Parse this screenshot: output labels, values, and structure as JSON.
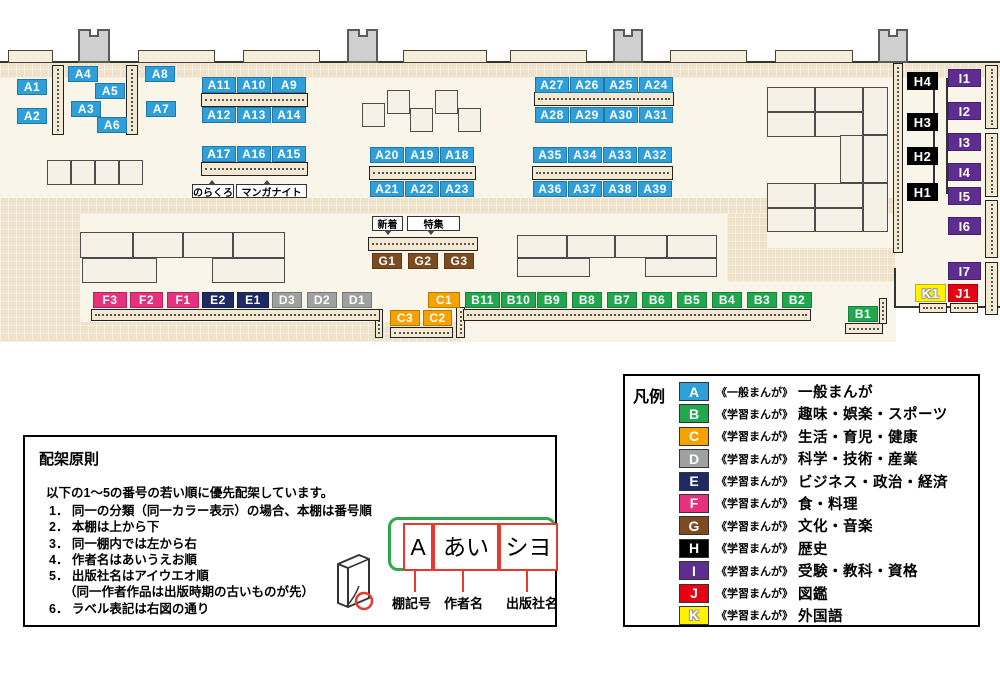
{
  "map": {
    "shelf_labels": [
      {
        "id": "A1",
        "cat": "A",
        "x": 17,
        "y": 79,
        "w": 30
      },
      {
        "id": "A2",
        "cat": "A",
        "x": 17,
        "y": 108,
        "w": 30
      },
      {
        "id": "A4",
        "cat": "A",
        "x": 68,
        "y": 66,
        "w": 30
      },
      {
        "id": "A5",
        "cat": "A",
        "x": 95,
        "y": 83,
        "w": 30
      },
      {
        "id": "A3",
        "cat": "A",
        "x": 71,
        "y": 101,
        "w": 30
      },
      {
        "id": "A6",
        "cat": "A",
        "x": 97,
        "y": 117,
        "w": 30
      },
      {
        "id": "A8",
        "cat": "A",
        "x": 145,
        "y": 66,
        "w": 30
      },
      {
        "id": "A7",
        "cat": "A",
        "x": 146,
        "y": 101,
        "w": 30
      },
      {
        "id": "A11",
        "cat": "A",
        "x": 202,
        "y": 77,
        "w": 34
      },
      {
        "id": "A10",
        "cat": "A",
        "x": 237,
        "y": 77,
        "w": 34
      },
      {
        "id": "A9",
        "cat": "A",
        "x": 272,
        "y": 77,
        "w": 34
      },
      {
        "id": "A12",
        "cat": "A",
        "x": 202,
        "y": 107,
        "w": 34
      },
      {
        "id": "A13",
        "cat": "A",
        "x": 237,
        "y": 107,
        "w": 34
      },
      {
        "id": "A14",
        "cat": "A",
        "x": 272,
        "y": 107,
        "w": 34
      },
      {
        "id": "A17",
        "cat": "A",
        "x": 202,
        "y": 146,
        "w": 34
      },
      {
        "id": "A16",
        "cat": "A",
        "x": 237,
        "y": 146,
        "w": 34
      },
      {
        "id": "A15",
        "cat": "A",
        "x": 272,
        "y": 146,
        "w": 34
      },
      {
        "id": "A20",
        "cat": "A",
        "x": 370,
        "y": 147,
        "w": 34
      },
      {
        "id": "A19",
        "cat": "A",
        "x": 405,
        "y": 147,
        "w": 34
      },
      {
        "id": "A18",
        "cat": "A",
        "x": 440,
        "y": 147,
        "w": 34
      },
      {
        "id": "A21",
        "cat": "A",
        "x": 370,
        "y": 181,
        "w": 34
      },
      {
        "id": "A22",
        "cat": "A",
        "x": 405,
        "y": 181,
        "w": 34
      },
      {
        "id": "A23",
        "cat": "A",
        "x": 440,
        "y": 181,
        "w": 34
      },
      {
        "id": "A27",
        "cat": "A",
        "x": 535,
        "y": 77,
        "w": 34
      },
      {
        "id": "A26",
        "cat": "A",
        "x": 570,
        "y": 77,
        "w": 34
      },
      {
        "id": "A25",
        "cat": "A",
        "x": 604,
        "y": 77,
        "w": 34
      },
      {
        "id": "A24",
        "cat": "A",
        "x": 639,
        "y": 77,
        "w": 34
      },
      {
        "id": "A28",
        "cat": "A",
        "x": 535,
        "y": 107,
        "w": 34
      },
      {
        "id": "A29",
        "cat": "A",
        "x": 570,
        "y": 107,
        "w": 34
      },
      {
        "id": "A30",
        "cat": "A",
        "x": 604,
        "y": 107,
        "w": 34
      },
      {
        "id": "A31",
        "cat": "A",
        "x": 639,
        "y": 107,
        "w": 34
      },
      {
        "id": "A35",
        "cat": "A",
        "x": 533,
        "y": 147,
        "w": 34
      },
      {
        "id": "A34",
        "cat": "A",
        "x": 568,
        "y": 147,
        "w": 34
      },
      {
        "id": "A33",
        "cat": "A",
        "x": 603,
        "y": 147,
        "w": 34
      },
      {
        "id": "A32",
        "cat": "A",
        "x": 638,
        "y": 147,
        "w": 34
      },
      {
        "id": "A36",
        "cat": "A",
        "x": 533,
        "y": 181,
        "w": 34
      },
      {
        "id": "A37",
        "cat": "A",
        "x": 568,
        "y": 181,
        "w": 34
      },
      {
        "id": "A38",
        "cat": "A",
        "x": 603,
        "y": 181,
        "w": 34
      },
      {
        "id": "A39",
        "cat": "A",
        "x": 638,
        "y": 181,
        "w": 34
      },
      {
        "id": "G1",
        "cat": "G",
        "x": 372,
        "y": 253,
        "w": 30
      },
      {
        "id": "G2",
        "cat": "G",
        "x": 408,
        "y": 253,
        "w": 30
      },
      {
        "id": "G3",
        "cat": "G",
        "x": 444,
        "y": 253,
        "w": 30
      },
      {
        "id": "F3",
        "cat": "F",
        "x": 93,
        "y": 292,
        "w": 34
      },
      {
        "id": "F2",
        "cat": "F",
        "x": 130,
        "y": 292,
        "w": 33
      },
      {
        "id": "F1",
        "cat": "F",
        "x": 167,
        "y": 292,
        "w": 32
      },
      {
        "id": "E2",
        "cat": "E",
        "x": 202,
        "y": 292,
        "w": 32
      },
      {
        "id": "E1",
        "cat": "E",
        "x": 237,
        "y": 292,
        "w": 32
      },
      {
        "id": "D3",
        "cat": "D",
        "x": 272,
        "y": 292,
        "w": 30
      },
      {
        "id": "D2",
        "cat": "D",
        "x": 307,
        "y": 292,
        "w": 30
      },
      {
        "id": "D1",
        "cat": "D",
        "x": 342,
        "y": 292,
        "w": 30
      },
      {
        "id": "C1",
        "cat": "C",
        "x": 428,
        "y": 292,
        "w": 32
      },
      {
        "id": "C3",
        "cat": "C",
        "x": 390,
        "y": 310,
        "w": 30
      },
      {
        "id": "C2",
        "cat": "C",
        "x": 423,
        "y": 310,
        "w": 29
      },
      {
        "id": "B11",
        "cat": "B",
        "x": 465,
        "y": 292,
        "w": 35
      },
      {
        "id": "B10",
        "cat": "B",
        "x": 501,
        "y": 292,
        "w": 35
      },
      {
        "id": "B9",
        "cat": "B",
        "x": 537,
        "y": 292,
        "w": 30
      },
      {
        "id": "B8",
        "cat": "B",
        "x": 572,
        "y": 292,
        "w": 30
      },
      {
        "id": "B7",
        "cat": "B",
        "x": 607,
        "y": 292,
        "w": 30
      },
      {
        "id": "B6",
        "cat": "B",
        "x": 642,
        "y": 292,
        "w": 30
      },
      {
        "id": "B5",
        "cat": "B",
        "x": 677,
        "y": 292,
        "w": 30
      },
      {
        "id": "B4",
        "cat": "B",
        "x": 712,
        "y": 292,
        "w": 30
      },
      {
        "id": "B3",
        "cat": "B",
        "x": 747,
        "y": 292,
        "w": 30
      },
      {
        "id": "B2",
        "cat": "B",
        "x": 782,
        "y": 292,
        "w": 30
      },
      {
        "id": "B1",
        "cat": "B",
        "x": 848,
        "y": 306,
        "w": 30
      },
      {
        "id": "H4",
        "cat": "H",
        "x": 907,
        "y": 72,
        "w": 31
      },
      {
        "id": "H3",
        "cat": "H",
        "x": 907,
        "y": 113,
        "w": 31
      },
      {
        "id": "H2",
        "cat": "H",
        "x": 907,
        "y": 147,
        "w": 31
      },
      {
        "id": "H1",
        "cat": "H",
        "x": 907,
        "y": 183,
        "w": 31
      },
      {
        "id": "I1",
        "cat": "I",
        "x": 948,
        "y": 69,
        "w": 33
      },
      {
        "id": "I2",
        "cat": "I",
        "x": 948,
        "y": 102,
        "w": 33
      },
      {
        "id": "I3",
        "cat": "I",
        "x": 948,
        "y": 133,
        "w": 33
      },
      {
        "id": "I4",
        "cat": "I",
        "x": 948,
        "y": 163,
        "w": 33
      },
      {
        "id": "I5",
        "cat": "I",
        "x": 948,
        "y": 187,
        "w": 33
      },
      {
        "id": "I6",
        "cat": "I",
        "x": 948,
        "y": 217,
        "w": 33
      },
      {
        "id": "I7",
        "cat": "I",
        "x": 948,
        "y": 262,
        "w": 33
      },
      {
        "id": "K1",
        "cat": "K",
        "x": 915,
        "y": 284,
        "w": 31
      },
      {
        "id": "J1",
        "cat": "J",
        "x": 948,
        "y": 284,
        "w": 30
      }
    ],
    "annotations": [
      {
        "text": "のらくろ",
        "x": 192,
        "y": 184,
        "w": 42,
        "h": 14,
        "ptr": "up"
      },
      {
        "text": "マンガナイト",
        "x": 236,
        "y": 184,
        "w": 71,
        "h": 14,
        "ptr": "up"
      },
      {
        "text": "新着",
        "x": 372,
        "y": 216,
        "w": 31,
        "h": 15,
        "ptr": "down"
      },
      {
        "text": "特集",
        "x": 407,
        "y": 216,
        "w": 53,
        "h": 15,
        "ptr": "down"
      }
    ]
  },
  "legend": {
    "title": "凡例",
    "items": [
      {
        "key": "A",
        "color": "#2E9FDA",
        "scope": "《一般まんが》",
        "label": "一般まんが"
      },
      {
        "key": "B",
        "color": "#21A84E",
        "scope": "《学習まんが》",
        "label": "趣味・娯楽・スポーツ"
      },
      {
        "key": "C",
        "color": "#F5A100",
        "scope": "《学習まんが》",
        "label": "生活・育児・健康"
      },
      {
        "key": "D",
        "color": "#9FA0A0",
        "scope": "《学習まんが》",
        "label": "科学・技術・産業"
      },
      {
        "key": "E",
        "color": "#1E2B63",
        "scope": "《学習まんが》",
        "label": "ビジネス・政治・経済"
      },
      {
        "key": "F",
        "color": "#E7317F",
        "scope": "《学習まんが》",
        "label": "食・料理"
      },
      {
        "key": "G",
        "color": "#7C4B21",
        "scope": "《学習まんが》",
        "label": "文化・音楽"
      },
      {
        "key": "H",
        "color": "#000000",
        "scope": "《学習まんが》",
        "label": "歴史"
      },
      {
        "key": "I",
        "color": "#5D2D90",
        "scope": "《学習まんが》",
        "label": "受験・教科・資格"
      },
      {
        "key": "J",
        "color": "#E60012",
        "scope": "《学習まんが》",
        "label": "図鑑"
      },
      {
        "key": "K",
        "color": "#FFF100",
        "scope": "《学習まんが》",
        "label": "外国語",
        "outline": true
      }
    ]
  },
  "principles": {
    "title": "配架原則",
    "intro": "以下の1～5の番号の若い順に優先配架しています。",
    "lines": [
      {
        "text": "1． 同一の分類（同一カラー表示）の場合、本棚は番号順"
      },
      {
        "text": "2． 本棚は上から下"
      },
      {
        "text": "3． 同一棚内では左から右"
      },
      {
        "text": "4． 作者名はあいうえお順"
      },
      {
        "text": "5． 出版社名はアイウエオ順"
      },
      {
        "text": "（同一作者作品は出版時期の古いものが先）",
        "indent": true
      },
      {
        "text": "6． ラベル表記は右図の通り"
      }
    ]
  },
  "label_diagram": {
    "fields": [
      {
        "code": "A",
        "label": "棚記号"
      },
      {
        "code": "あい",
        "label": "作者名"
      },
      {
        "code": "シヨ",
        "label": "出版社名"
      }
    ]
  }
}
